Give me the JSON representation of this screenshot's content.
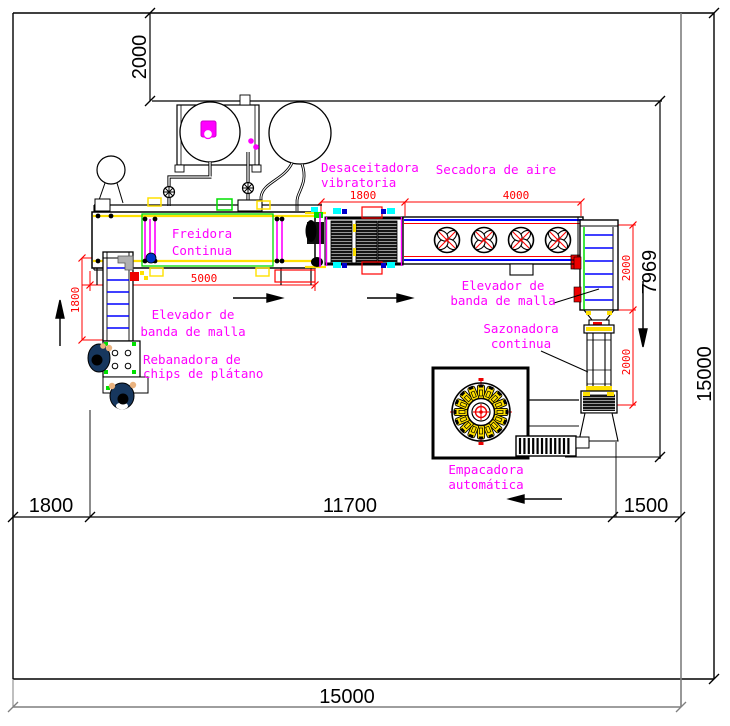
{
  "drawing_title": "Plantain chips production line layout",
  "labels": {
    "freidora": [
      "Freidora",
      "Continua"
    ],
    "desaceitadora": [
      "Desaceitadora",
      "vibratoria"
    ],
    "secadora": [
      "Secadora de aire"
    ],
    "elevador1": [
      "Elevador de",
      "banda de malla"
    ],
    "rebanadora": [
      "Rebanadora de",
      "chips de plátano"
    ],
    "elevador2": [
      "Elevador de",
      "banda de malla"
    ],
    "sazonadora": [
      "Sazonadora",
      "continua"
    ],
    "empacadora": [
      "Empacadora",
      "automática"
    ]
  },
  "dims_red": {
    "elevador1": "1800",
    "freidora": "5000",
    "desaceitadora": "1800",
    "secadora": "4000",
    "elevador2": "2000",
    "sazonadora": "2000"
  },
  "dims_black": {
    "top_offset": "2000",
    "interior_height": "7969",
    "site_height": "15000",
    "bottom_left": "1800",
    "bottom_center": "11700",
    "bottom_right": "1500",
    "site_width": "15000"
  },
  "colors": {
    "dimension_red": "#ff0000",
    "label_magenta": "#ff00ff",
    "machine_yellow": "#ffe000",
    "machine_green": "#00e000",
    "machine_blue": "#0000ff",
    "wall_gray": "#7f7f7f",
    "operator_navy": "#17375e"
  }
}
